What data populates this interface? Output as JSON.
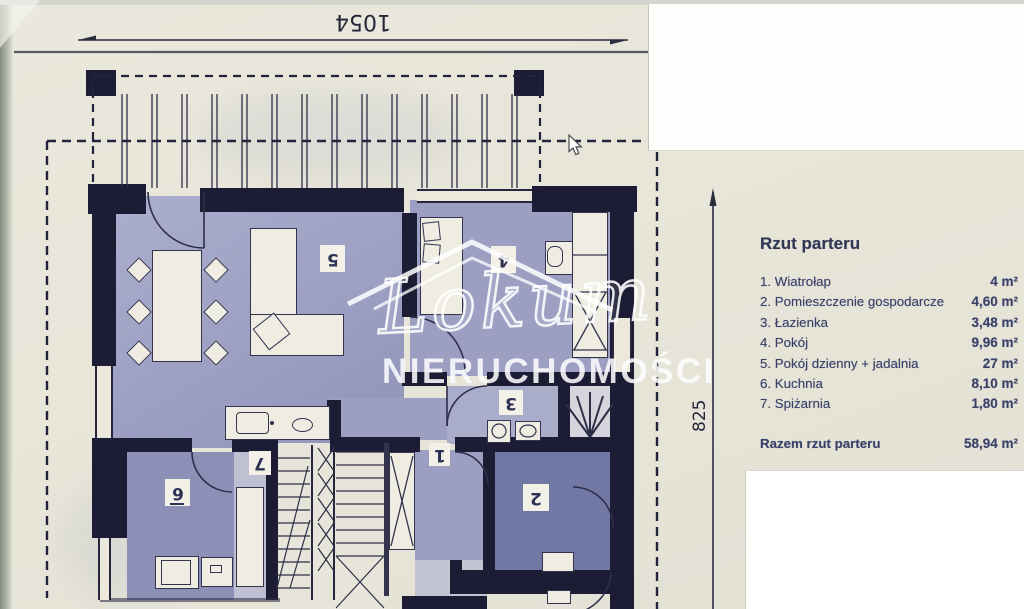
{
  "photo": {
    "dimension_top": "1054",
    "dimension_right": "825",
    "room_numbers": {
      "r1": "1",
      "r2": "2",
      "r3": "3",
      "r4": "4",
      "r5": "5",
      "r6": "6",
      "r7": "7"
    },
    "watermark": {
      "brand": "Lokum",
      "subtitle": "NIERUCHOMOŚCI"
    }
  },
  "legend": {
    "title": "Rzut parteru",
    "items": [
      {
        "label": "1. Wiatrołap",
        "value": "4 m²"
      },
      {
        "label": "2. Pomieszczenie gospodarcze",
        "value": "4,60 m²"
      },
      {
        "label": "3. Łazienka",
        "value": "3,48 m²"
      },
      {
        "label": "4. Pokój",
        "value": "9,96 m²"
      },
      {
        "label": "5. Pokój dzienny + jadalnia",
        "value": "27 m²"
      },
      {
        "label": "6. Kuchnia",
        "value": "8,10 m²"
      },
      {
        "label": "7. Spiżarnia",
        "value": "1,80 m²"
      }
    ],
    "total_label": "Razem rzut parteru",
    "total_value": "58,94 m²"
  }
}
